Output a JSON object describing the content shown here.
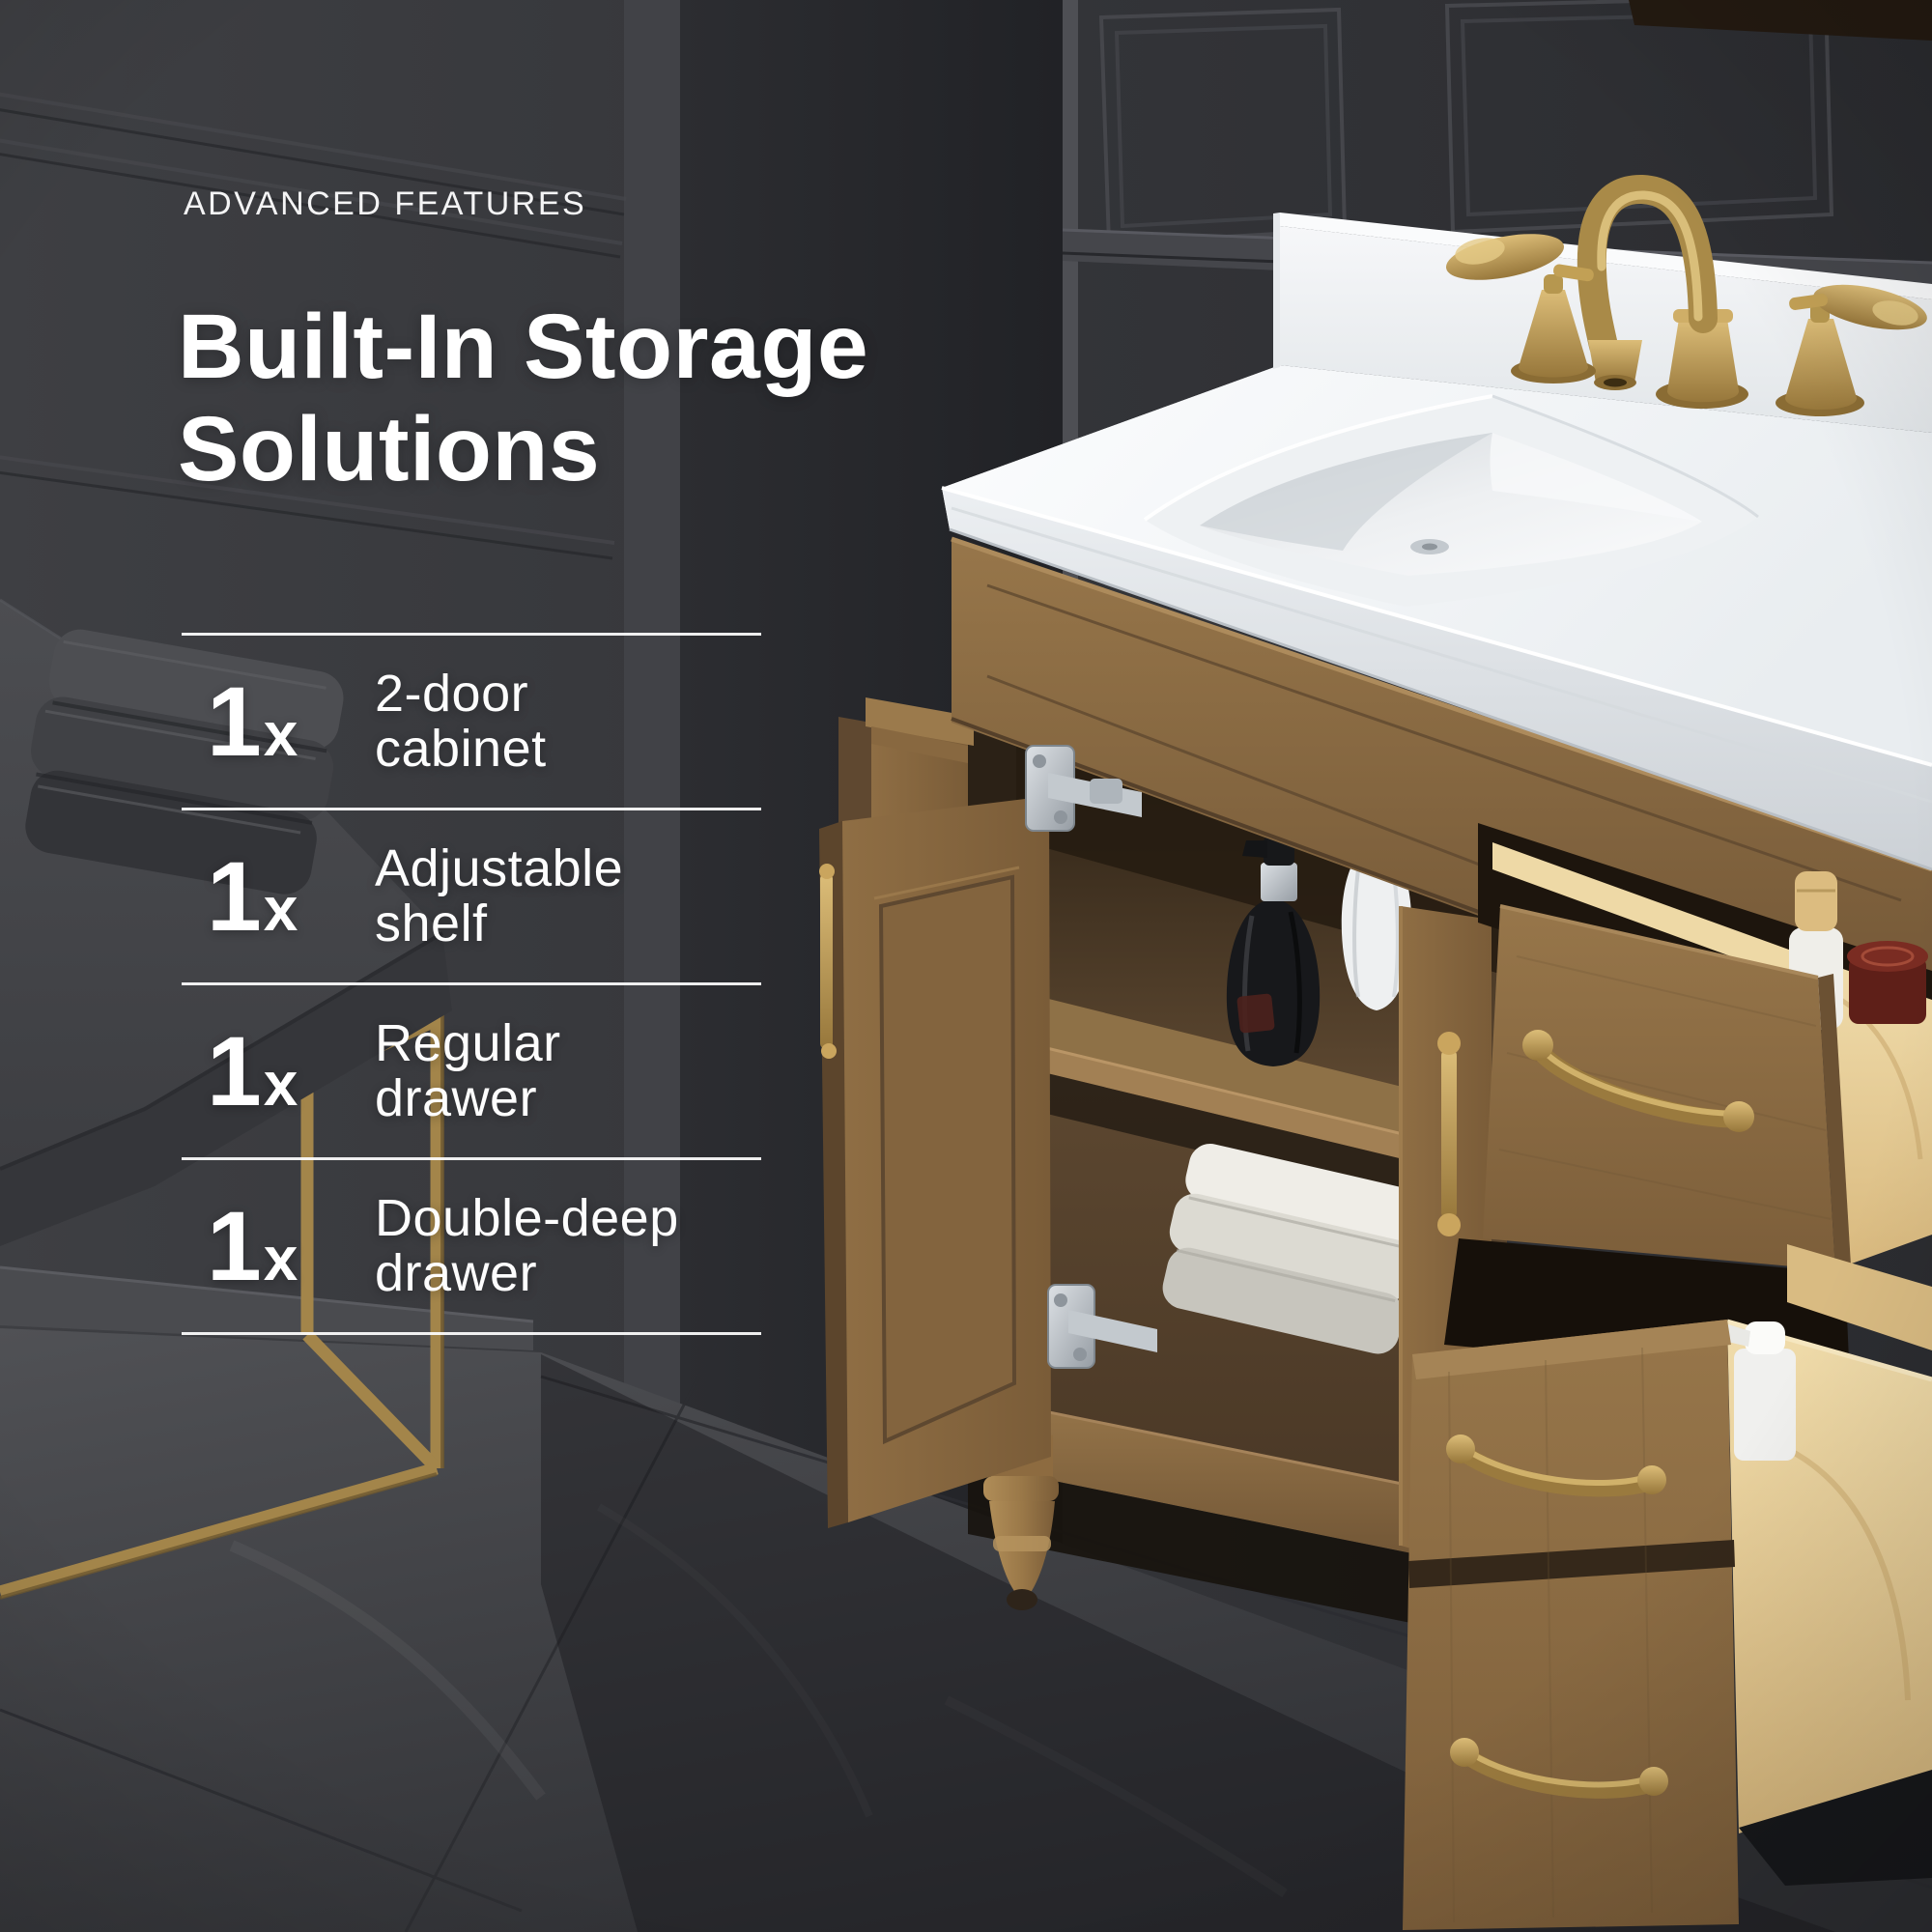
{
  "header": {
    "eyebrow": "ADVANCED FEATURES"
  },
  "title": {
    "line1": "Built-In Storage",
    "line2": "Solutions"
  },
  "features": [
    {
      "qty": "1",
      "mult": "x",
      "line1": "2-door",
      "line2": "cabinet"
    },
    {
      "qty": "1",
      "mult": "x",
      "line1": "Adjustable",
      "line2": "shelf"
    },
    {
      "qty": "1",
      "mult": "x",
      "line1": "Regular",
      "line2": "drawer"
    },
    {
      "qty": "1",
      "mult": "x",
      "line1": "Double-deep",
      "line2": "drawer"
    }
  ],
  "colors": {
    "text": "#ffffff",
    "wall_charcoal": "#323338",
    "accent_gold": "#b5954e",
    "vanity_wood": "#8a6a42",
    "drawer_pine": "#e6cc96",
    "counter_white": "#f4f6f7",
    "floor_grey": "#404145"
  }
}
